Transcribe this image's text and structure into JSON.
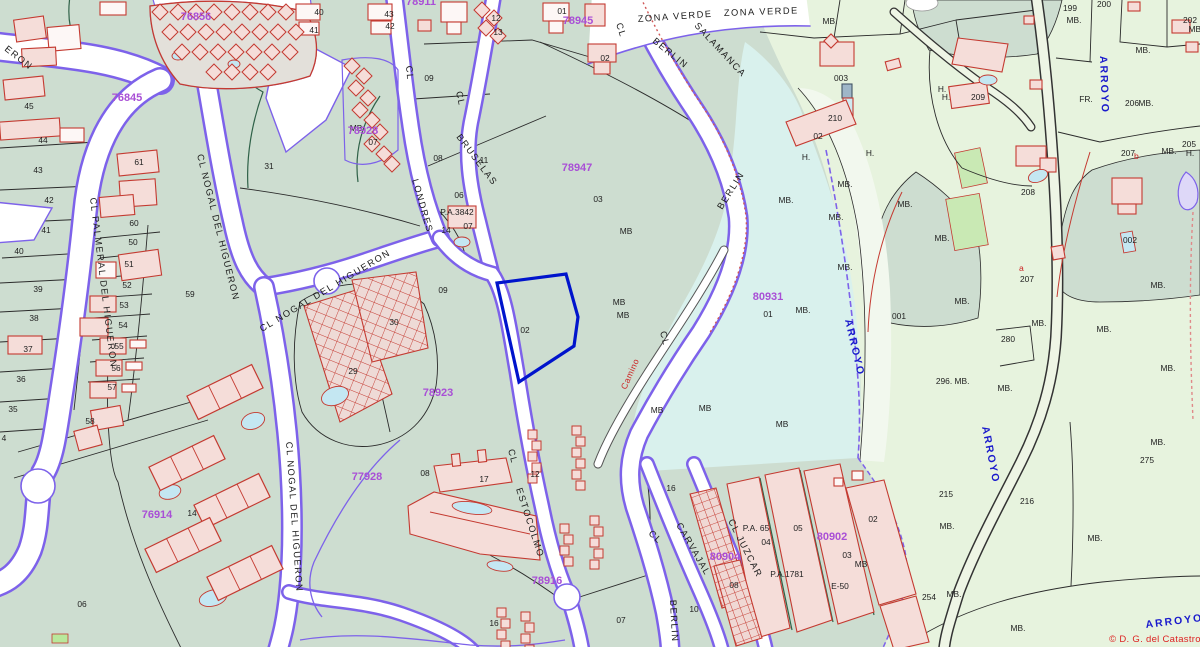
{
  "map": {
    "attribution": "© D. G. del Catastro",
    "colors": {
      "base_zone": "#cdddd0",
      "green_zone": "#e7f3de",
      "cyan_zone": "#d9f1ed",
      "street_border": "#7d62ea",
      "building_outline": "#c43a31",
      "block_label": "#a94fd6",
      "water_label": "#1a1acc",
      "annotation_red": "#cc2222",
      "selected_parcel": "#0014cc"
    },
    "labels": {
      "blocks": [
        {
          "t": "76845",
          "x": 127,
          "y": 101
        },
        {
          "t": "76856",
          "x": 196,
          "y": 20
        },
        {
          "t": "78911",
          "x": 421,
          "y": 5
        },
        {
          "t": "78945",
          "x": 578,
          "y": 24
        },
        {
          "t": "78928",
          "x": 363,
          "y": 134
        },
        {
          "t": "78947",
          "x": 577,
          "y": 171
        },
        {
          "t": "78923",
          "x": 438,
          "y": 396
        },
        {
          "t": "80931",
          "x": 768,
          "y": 300
        },
        {
          "t": "77928",
          "x": 367,
          "y": 480
        },
        {
          "t": "78916",
          "x": 547,
          "y": 584
        },
        {
          "t": "76914",
          "x": 157,
          "y": 518
        },
        {
          "t": "80902",
          "x": 832,
          "y": 540
        },
        {
          "t": "80904",
          "x": 725,
          "y": 560
        }
      ],
      "streets": [
        {
          "t": "ERON",
          "x": 4,
          "y": 50,
          "r": 38
        },
        {
          "t": "CL PALMERAL DEL HIGUERON",
          "x": 90,
          "y": 198,
          "r": 83
        },
        {
          "t": "CL NOGAL DEL HIGUERON",
          "x": 197,
          "y": 155,
          "r": 76
        },
        {
          "t": "CL NOGAL DEL HIGUERON",
          "x": 262,
          "y": 332,
          "r": -31
        },
        {
          "t": "CL NOGAL DEL HIGUERON",
          "x": 286,
          "y": 442,
          "r": 86
        },
        {
          "t": "CL",
          "x": 406,
          "y": 66,
          "r": 85
        },
        {
          "t": "LONDRES",
          "x": 412,
          "y": 180,
          "r": 74
        },
        {
          "t": "CL",
          "x": 456,
          "y": 92,
          "r": 78
        },
        {
          "t": "BRUSELAS",
          "x": 456,
          "y": 137,
          "r": 53
        },
        {
          "t": "CL",
          "x": 616,
          "y": 24,
          "r": 72
        },
        {
          "t": "BERLIN",
          "x": 652,
          "y": 42,
          "r": 39
        },
        {
          "t": "ZONA VERDE",
          "x": 638,
          "y": 22,
          "r": -4,
          "fs": 9.5
        },
        {
          "t": "SALAMANCA",
          "x": 694,
          "y": 26,
          "r": 47,
          "fs": 9.5
        },
        {
          "t": "ZONA VERDE",
          "x": 724,
          "y": 16,
          "r": -2,
          "fs": 9.5
        },
        {
          "t": "BERLIN",
          "x": 722,
          "y": 210,
          "r": -58,
          "fs": 10
        },
        {
          "t": "CL",
          "x": 660,
          "y": 332,
          "r": 76
        },
        {
          "t": "CL",
          "x": 508,
          "y": 450,
          "r": 75
        },
        {
          "t": "ESTOCOLMO",
          "x": 516,
          "y": 489,
          "r": 72
        },
        {
          "t": "CL",
          "x": 648,
          "y": 534,
          "r": 44
        },
        {
          "t": "CARVAJAL",
          "x": 676,
          "y": 525,
          "r": 60
        },
        {
          "t": "CL JUZCAR",
          "x": 728,
          "y": 521,
          "r": 63
        },
        {
          "t": "BERLIN",
          "x": 670,
          "y": 600,
          "r": 87
        }
      ],
      "water": [
        {
          "t": "ARROYO",
          "x": 1100,
          "y": 56,
          "r": 88
        },
        {
          "t": "ARROYO",
          "x": 845,
          "y": 320,
          "r": 77
        },
        {
          "t": "ARROYO",
          "x": 982,
          "y": 427,
          "r": 79
        },
        {
          "t": "ARROYO",
          "x": 1146,
          "y": 628,
          "r": -7,
          "fs": 13
        }
      ],
      "annotations": [
        {
          "t": "Camino",
          "x": 626,
          "y": 390,
          "r": -66
        },
        {
          "t": "a",
          "x": 1019,
          "y": 271,
          "r": 0
        },
        {
          "t": "b",
          "x": 1134,
          "y": 159,
          "r": 0
        }
      ],
      "parcels": [
        {
          "t": "45",
          "x": 29,
          "y": 109
        },
        {
          "t": "44",
          "x": 43,
          "y": 143
        },
        {
          "t": "43",
          "x": 38,
          "y": 173
        },
        {
          "t": "42",
          "x": 49,
          "y": 203
        },
        {
          "t": "41",
          "x": 46,
          "y": 233
        },
        {
          "t": "40",
          "x": 19,
          "y": 254
        },
        {
          "t": "39",
          "x": 38,
          "y": 292
        },
        {
          "t": "38",
          "x": 34,
          "y": 321
        },
        {
          "t": "37",
          "x": 28,
          "y": 352
        },
        {
          "t": "36",
          "x": 21,
          "y": 382
        },
        {
          "t": "35",
          "x": 13,
          "y": 412
        },
        {
          "t": "4",
          "x": 4,
          "y": 441
        },
        {
          "t": "61",
          "x": 139,
          "y": 165
        },
        {
          "t": "60",
          "x": 134,
          "y": 226
        },
        {
          "t": "50",
          "x": 133,
          "y": 245
        },
        {
          "t": "51",
          "x": 129,
          "y": 267
        },
        {
          "t": "52",
          "x": 127,
          "y": 288
        },
        {
          "t": "53",
          "x": 124,
          "y": 308
        },
        {
          "t": "54",
          "x": 123,
          "y": 328
        },
        {
          "t": "55",
          "x": 119,
          "y": 349
        },
        {
          "t": "56",
          "x": 116,
          "y": 371
        },
        {
          "t": "57",
          "x": 112,
          "y": 390
        },
        {
          "t": "58",
          "x": 90,
          "y": 424
        },
        {
          "t": "31",
          "x": 269,
          "y": 169
        },
        {
          "t": "59",
          "x": 190,
          "y": 297
        },
        {
          "t": "40",
          "x": 319,
          "y": 15
        },
        {
          "t": "41",
          "x": 314,
          "y": 33
        },
        {
          "t": "43",
          "x": 389,
          "y": 17
        },
        {
          "t": "42",
          "x": 390,
          "y": 29
        },
        {
          "t": "12",
          "x": 496,
          "y": 21
        },
        {
          "t": "13",
          "x": 498,
          "y": 35
        },
        {
          "t": "01",
          "x": 562,
          "y": 14
        },
        {
          "t": "02",
          "x": 605,
          "y": 61
        },
        {
          "t": "MB",
          "x": 356,
          "y": 131
        },
        {
          "t": "07",
          "x": 373,
          "y": 145
        },
        {
          "t": "08",
          "x": 438,
          "y": 161
        },
        {
          "t": "11",
          "x": 484,
          "y": 163
        },
        {
          "t": "06",
          "x": 459,
          "y": 198
        },
        {
          "t": "P.A.3842",
          "x": 457,
          "y": 215
        },
        {
          "t": "14",
          "x": 446,
          "y": 233
        },
        {
          "t": "07",
          "x": 468,
          "y": 229
        },
        {
          "t": "09",
          "x": 429,
          "y": 81
        },
        {
          "t": "09",
          "x": 443,
          "y": 293
        },
        {
          "t": "30",
          "x": 394,
          "y": 325
        },
        {
          "t": "29",
          "x": 353,
          "y": 374
        },
        {
          "t": "02",
          "x": 525,
          "y": 333
        },
        {
          "t": "03",
          "x": 598,
          "y": 202
        },
        {
          "t": "MB",
          "x": 626,
          "y": 234
        },
        {
          "t": "MB",
          "x": 619,
          "y": 305
        },
        {
          "t": "MB",
          "x": 623,
          "y": 318
        },
        {
          "t": "MB",
          "x": 657,
          "y": 413
        },
        {
          "t": "MB",
          "x": 705,
          "y": 411
        },
        {
          "t": "MB",
          "x": 782,
          "y": 427
        },
        {
          "t": "06",
          "x": 82,
          "y": 607
        },
        {
          "t": "14",
          "x": 192,
          "y": 516
        },
        {
          "t": "08",
          "x": 425,
          "y": 476
        },
        {
          "t": "17",
          "x": 484,
          "y": 482
        },
        {
          "t": "12",
          "x": 535,
          "y": 477
        },
        {
          "t": "16",
          "x": 494,
          "y": 626
        },
        {
          "t": "07",
          "x": 621,
          "y": 623
        },
        {
          "t": "10",
          "x": 694,
          "y": 612
        },
        {
          "t": "16",
          "x": 671,
          "y": 491
        },
        {
          "t": "MB.",
          "x": 830,
          "y": 24
        },
        {
          "t": "003",
          "x": 841,
          "y": 81
        },
        {
          "t": "210",
          "x": 835,
          "y": 121
        },
        {
          "t": "02",
          "x": 818,
          "y": 139
        },
        {
          "t": "H.",
          "x": 806,
          "y": 160
        },
        {
          "t": "H.",
          "x": 870,
          "y": 156
        },
        {
          "t": "MB.",
          "x": 845,
          "y": 187
        },
        {
          "t": "MB.",
          "x": 786,
          "y": 203
        },
        {
          "t": "MB.",
          "x": 836,
          "y": 220
        },
        {
          "t": "MB.",
          "x": 905,
          "y": 207
        },
        {
          "t": "MB.",
          "x": 942,
          "y": 241
        },
        {
          "t": "MB.",
          "x": 845,
          "y": 270
        },
        {
          "t": "01",
          "x": 768,
          "y": 317
        },
        {
          "t": "MB.",
          "x": 803,
          "y": 313
        },
        {
          "t": "MB.",
          "x": 962,
          "y": 304
        },
        {
          "t": "001",
          "x": 899,
          "y": 319
        },
        {
          "t": "199",
          "x": 1070,
          "y": 11
        },
        {
          "t": "MB.",
          "x": 1074,
          "y": 23
        },
        {
          "t": "200",
          "x": 1104,
          "y": 7
        },
        {
          "t": "202",
          "x": 1190,
          "y": 23
        },
        {
          "t": "MB.",
          "x": 1196,
          "y": 32
        },
        {
          "t": "MB.",
          "x": 1143,
          "y": 53
        },
        {
          "t": "H.",
          "x": 942,
          "y": 92
        },
        {
          "t": "H.",
          "x": 946,
          "y": 100
        },
        {
          "t": "209",
          "x": 978,
          "y": 100
        },
        {
          "t": "FR.",
          "x": 1086,
          "y": 102
        },
        {
          "t": "206",
          "x": 1132,
          "y": 106
        },
        {
          "t": "MB.",
          "x": 1146,
          "y": 106
        },
        {
          "t": "207",
          "x": 1128,
          "y": 156
        },
        {
          "t": "205",
          "x": 1189,
          "y": 147
        },
        {
          "t": "MB.",
          "x": 1169,
          "y": 154
        },
        {
          "t": "H.",
          "x": 1190,
          "y": 156
        },
        {
          "t": "208",
          "x": 1028,
          "y": 195
        },
        {
          "t": "002",
          "x": 1130,
          "y": 243
        },
        {
          "t": "207",
          "x": 1027,
          "y": 282
        },
        {
          "t": "MB.",
          "x": 1158,
          "y": 288
        },
        {
          "t": "280",
          "x": 1008,
          "y": 342
        },
        {
          "t": "MB.",
          "x": 1039,
          "y": 326
        },
        {
          "t": "MB.",
          "x": 1104,
          "y": 332
        },
        {
          "t": "MB.",
          "x": 1168,
          "y": 371
        },
        {
          "t": "296.",
          "x": 944,
          "y": 384
        },
        {
          "t": "MB.",
          "x": 962,
          "y": 384
        },
        {
          "t": "MB.",
          "x": 1005,
          "y": 391
        },
        {
          "t": "215",
          "x": 946,
          "y": 497
        },
        {
          "t": "216",
          "x": 1027,
          "y": 504
        },
        {
          "t": "275",
          "x": 1147,
          "y": 463
        },
        {
          "t": "MB.",
          "x": 1158,
          "y": 445
        },
        {
          "t": "MB.",
          "x": 947,
          "y": 529
        },
        {
          "t": "MB.",
          "x": 1095,
          "y": 541
        },
        {
          "t": "254",
          "x": 929,
          "y": 600
        },
        {
          "t": "MB.",
          "x": 954,
          "y": 597
        },
        {
          "t": "MB.",
          "x": 1018,
          "y": 631
        },
        {
          "t": "P.A. 65",
          "x": 756,
          "y": 531
        },
        {
          "t": "05",
          "x": 798,
          "y": 531
        },
        {
          "t": "04",
          "x": 766,
          "y": 545
        },
        {
          "t": "03",
          "x": 847,
          "y": 558
        },
        {
          "t": "MB",
          "x": 861,
          "y": 567
        },
        {
          "t": "P.A.1781",
          "x": 787,
          "y": 577
        },
        {
          "t": "E-50",
          "x": 840,
          "y": 589
        },
        {
          "t": "08",
          "x": 734,
          "y": 588
        },
        {
          "t": "02",
          "x": 873,
          "y": 522
        }
      ]
    }
  }
}
